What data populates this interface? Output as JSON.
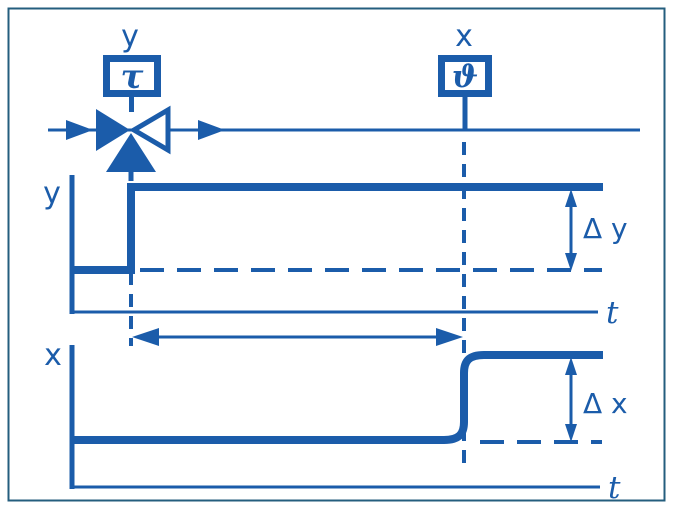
{
  "colors": {
    "line_blue": "#1b5caa",
    "frame_blue": "#245e7e",
    "background": "#ffffff"
  },
  "schematic": {
    "actuator_signal_label": "y",
    "actuator_box_symbol": "τ",
    "sensor_signal_label": "x",
    "sensor_box_symbol": "ϑ",
    "icons": {
      "valve": "three-way-valve-icon",
      "flow_direction": "right-arrowheads"
    }
  },
  "y_plot": {
    "axis_label": "y",
    "time_axis_label": "t",
    "delta_label": "Δ y",
    "curve_type": "step-up-at-actuation-time"
  },
  "x_plot": {
    "axis_label": "x",
    "time_axis_label": "t",
    "delta_label": "Δ x",
    "curve_type": "delayed-s-shaped-step (dead time between dashed verticals)"
  }
}
